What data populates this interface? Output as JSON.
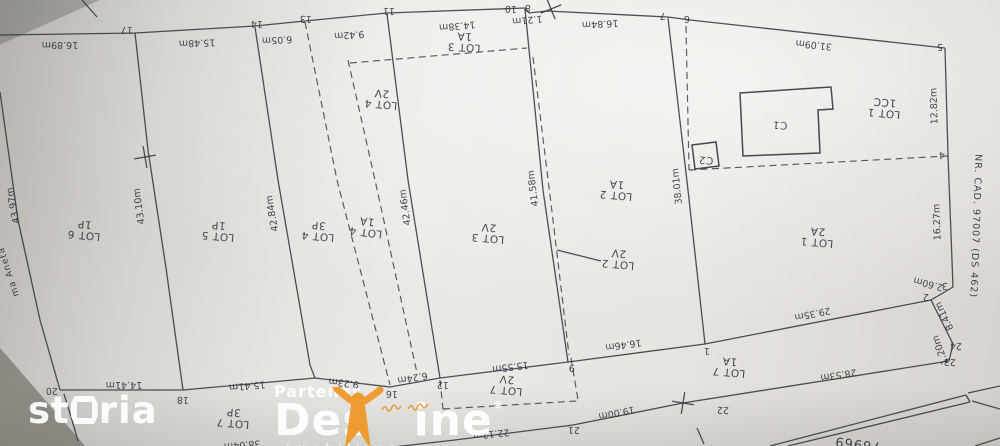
{
  "colors": {
    "ink": "#31313c",
    "orange": "#ef9a2d",
    "white": "#ffffff"
  },
  "watermarks": {
    "storia": {
      "text_left": "st",
      "text_right": "ria"
    },
    "destine": {
      "partener": "Partener",
      "brand_left": "Des",
      "brand_right": "ine",
      "registered": "®",
      "subtitle": "imobiliare"
    }
  },
  "plan": {
    "neighbor_label": {
      "t": "ma Aneta",
      "x": 11,
      "y": 271,
      "r": 252,
      "size": 9,
      "sp": 1
    },
    "right_road_label": {
      "t": "NR. CAD. 97007 (DS 462)",
      "x": 973,
      "y": 226,
      "r": 92,
      "size": 9.5,
      "sp": 1
    },
    "bottom_road_number": {
      "t": "76969",
      "x": 858,
      "y": 440,
      "r": 187,
      "size": 13,
      "sp": 1
    },
    "lots": [
      {
        "name": "LOT 6",
        "use": "1P",
        "x": 84,
        "y": 232,
        "r": 185
      },
      {
        "name": "LOT 5",
        "use": "1P",
        "x": 218,
        "y": 233,
        "r": 185
      },
      {
        "name": "LOT 4",
        "use": "3P",
        "x": 318,
        "y": 233,
        "r": 185
      },
      {
        "name": "LOT 4",
        "use": "1A",
        "x": 366,
        "y": 229,
        "r": 187
      },
      {
        "name": "LOT 4",
        "use": "2V",
        "x": 381,
        "y": 101,
        "r": 185
      },
      {
        "name": "LOT 3",
        "use": "1A",
        "x": 464,
        "y": 44,
        "r": 183
      },
      {
        "name": "LOT 3",
        "use": "2V",
        "x": 488,
        "y": 235,
        "r": 185
      },
      {
        "name": "LOT 2",
        "use": "1A",
        "x": 616,
        "y": 192,
        "r": 185
      },
      {
        "name": "LOT 2",
        "use": "2V",
        "x": 618,
        "y": 261,
        "r": 185
      },
      {
        "name": "LOT 1",
        "use": "1CC",
        "x": 884,
        "y": 110,
        "r": 185
      },
      {
        "name": "LOT 1",
        "use": "2A",
        "x": 817,
        "y": 239,
        "r": 185
      },
      {
        "name": "LOT 7",
        "use": "3P",
        "x": 233,
        "y": 420,
        "r": 185
      },
      {
        "name": "LOT 7",
        "use": "2V",
        "x": 506,
        "y": 387,
        "r": 185
      },
      {
        "name": "LOT 7",
        "use": "1A",
        "x": 729,
        "y": 369,
        "r": 185
      }
    ],
    "buildings": [
      {
        "label": "C1",
        "points": "740,93 815,88 831,87 833,109 818,110 820,153 743,156",
        "lx": 780,
        "ly": 122
      },
      {
        "label": "C2",
        "points": "692,145 716,142 719,166 695,169",
        "lx": 706,
        "ly": 157
      }
    ],
    "points": [
      {
        "n": "17",
        "x": 127,
        "y": 27
      },
      {
        "n": "14",
        "x": 257,
        "y": 21
      },
      {
        "n": "13",
        "x": 306,
        "y": 16
      },
      {
        "n": "11",
        "x": 389,
        "y": 8
      },
      {
        "n": "10",
        "x": 511,
        "y": 6
      },
      {
        "n": "8",
        "x": 528,
        "y": 5
      },
      {
        "n": "7",
        "x": 663,
        "y": 13
      },
      {
        "n": "6",
        "x": 687,
        "y": 16
      },
      {
        "n": "5",
        "x": 940,
        "y": 44
      },
      {
        "n": "4",
        "x": 942,
        "y": 152
      },
      {
        "n": "3",
        "x": 945,
        "y": 283
      },
      {
        "n": "2",
        "x": 926,
        "y": 294
      },
      {
        "n": "24",
        "x": 956,
        "y": 343
      },
      {
        "n": "23",
        "x": 950,
        "y": 359
      },
      {
        "n": "22",
        "x": 723,
        "y": 407
      },
      {
        "n": "21",
        "x": 574,
        "y": 427
      },
      {
        "n": "20",
        "x": 52,
        "y": 388
      },
      {
        "n": "18",
        "x": 183,
        "y": 397
      },
      {
        "n": "16",
        "x": 392,
        "y": 391
      },
      {
        "n": "12",
        "x": 443,
        "y": 382
      },
      {
        "n": "9",
        "x": 572,
        "y": 365
      },
      {
        "n": "1",
        "x": 707,
        "y": 348
      }
    ],
    "measurements": [
      {
        "t": "16.89m",
        "x": 60,
        "y": 42,
        "r": 180
      },
      {
        "t": "15.48m",
        "x": 197,
        "y": 40,
        "r": 178
      },
      {
        "t": "6.05m",
        "x": 277,
        "y": 37,
        "r": 177
      },
      {
        "t": "9.42m",
        "x": 349,
        "y": 32,
        "r": 176
      },
      {
        "t": "14.38m",
        "x": 457,
        "y": 23,
        "r": 175
      },
      {
        "t": "1.21m",
        "x": 527,
        "y": 17,
        "r": 175
      },
      {
        "t": "16.84m",
        "x": 600,
        "y": 21,
        "r": 177
      },
      {
        "t": "31.09m",
        "x": 814,
        "y": 42,
        "r": 186
      },
      {
        "t": "12.82m",
        "x": 937,
        "y": 106,
        "r": 268
      },
      {
        "t": "16.27m",
        "x": 940,
        "y": 222,
        "r": 268
      },
      {
        "t": "2.60m",
        "x": 929,
        "y": 281,
        "r": 195
      },
      {
        "t": "8.41m",
        "x": 947,
        "y": 315,
        "r": 244
      },
      {
        "t": "1.20m",
        "x": 943,
        "y": 349,
        "r": 250
      },
      {
        "t": "43.97m",
        "x": 16,
        "y": 205,
        "r": 259
      },
      {
        "t": "43.10m",
        "x": 142,
        "y": 206,
        "r": 262
      },
      {
        "t": "42.84m",
        "x": 275,
        "y": 213,
        "r": 260
      },
      {
        "t": "42.46m",
        "x": 408,
        "y": 207,
        "r": 262
      },
      {
        "t": "41.58m",
        "x": 536,
        "y": 188,
        "r": 263
      },
      {
        "t": "38.01m",
        "x": 680,
        "y": 186,
        "r": 264
      },
      {
        "t": "14.41m",
        "x": 124,
        "y": 382,
        "r": 180
      },
      {
        "t": "15.41m",
        "x": 247,
        "y": 383,
        "r": 175
      },
      {
        "t": "9.23m",
        "x": 344,
        "y": 380,
        "r": 187
      },
      {
        "t": "6.24m",
        "x": 412,
        "y": 375,
        "r": 170
      },
      {
        "t": "15.55m",
        "x": 510,
        "y": 364,
        "r": 173
      },
      {
        "t": "16.46m",
        "x": 623,
        "y": 342,
        "r": 172
      },
      {
        "t": "29.35m",
        "x": 812,
        "y": 311,
        "r": 169
      },
      {
        "t": "28.53m",
        "x": 838,
        "y": 372,
        "r": 171
      },
      {
        "t": "19.00m",
        "x": 616,
        "y": 410,
        "r": 169
      },
      {
        "t": "22.12m",
        "x": 491,
        "y": 431,
        "r": 174
      },
      {
        "t": "38.04m",
        "x": 242,
        "y": 442,
        "r": 175
      }
    ],
    "solid_lines": [
      "0,35 135,33 255,26 305,21 387,13 525,8 529,13 547,11 668,17 690,20 945,48",
      "945,48 948,155 953,287 931,300 953,344 949,361",
      "949,361 683,403 573,425 455,440 393,447",
      "0,92 18,220 40,320 60,390",
      "60,390 183,390 315,378 390,387 440,378 568,362 705,344 931,300",
      "135,33 148,150 166,268 183,390",
      "255,27 278,180 310,365 315,378",
      "387,14 408,180 440,378",
      "525,9 543,190 568,362",
      "668,18 688,190 705,344",
      "64,394 72,420 78,441",
      "557,250 601,261",
      "82,0 97,17",
      "697,428 704,444",
      "770,446 966,395",
      "788,446 970,402",
      "966,395 970,402",
      "972,401 1000,409",
      "968,393 1000,386",
      "975,446 1000,438"
    ],
    "dashed_lines": [
      "305,22 337,180 390,385",
      "348,60 375,180 417,373",
      "533,57 553,220 569,355",
      "686,26 689,170",
      "689,170 948,156",
      "350,63 527,48",
      "440,380 443,409",
      "443,409 577,401",
      "571,358 578,400"
    ],
    "crosses": [
      {
        "x": 145,
        "y": 157,
        "r": 80
      },
      {
        "x": 551,
        "y": 9,
        "r": 68
      },
      {
        "x": 683,
        "y": 403,
        "r": 99
      }
    ]
  }
}
